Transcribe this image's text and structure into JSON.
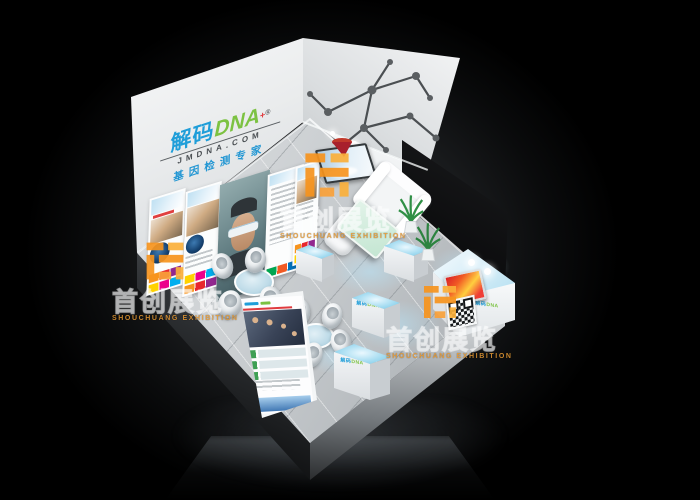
{
  "scene": {
    "description": "3D concept render of a DNA-testing brand exhibition booth viewed from above on a black studio background"
  },
  "brand": {
    "logo_cn": "解码",
    "logo_en": "DNA",
    "registered_mark": "®",
    "medical_cross": "+",
    "website": "JMDNA.COM",
    "tagline": "基因检测专家"
  },
  "watermark": {
    "cn": "首创展览",
    "en": "SHOUCHUANG EXHIBITION"
  },
  "colors": {
    "brand_blue": "#1f9ed9",
    "brand_green": "#7cc242",
    "accent_red": "#e03a3e",
    "watermark_orange": "#f7941e",
    "glow_cyan": "#a5dcf1",
    "glass_green": "#c4e6d2",
    "floor_grey": "#c6cacd",
    "background": "#000000"
  }
}
